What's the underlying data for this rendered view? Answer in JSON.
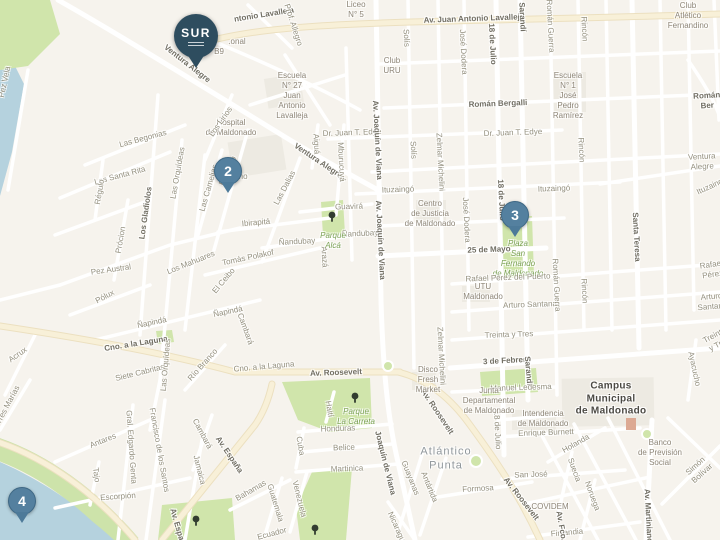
{
  "markers": [
    {
      "id": "sur",
      "label": "SUR"
    },
    {
      "id": "2",
      "label": "2"
    },
    {
      "id": "3",
      "label": "3"
    },
    {
      "id": "4",
      "label": "4"
    }
  ],
  "colors": {
    "background": "#f6f3ed",
    "water": "#b5d2de",
    "park": "#d0e5ab",
    "road_major": "#f8f0d8",
    "marker_blue": "#54809f",
    "sur_pin": "#2e4d5f"
  },
  "labels": [
    {
      "t": "ntonio Lavalleja",
      "x": 264,
      "y": 15,
      "r": -9,
      "c": "stb"
    },
    {
      "t": "Liceo\nN° 5",
      "x": 356,
      "y": 10,
      "r": 0,
      "c": "poi"
    },
    {
      "t": "Av. Juan Antonio Lavalleja",
      "x": 474,
      "y": 19,
      "r": -2,
      "c": "stb"
    },
    {
      "t": "Sarandí",
      "x": 522,
      "y": 17,
      "r": 87,
      "c": "stb"
    },
    {
      "t": "Román Guerra",
      "x": 550,
      "y": 26,
      "r": 87,
      "c": "st"
    },
    {
      "t": "Rincón",
      "x": 584,
      "y": 29,
      "r": 87,
      "c": "st"
    },
    {
      "t": "Club\nAtlético\nFernandino",
      "x": 688,
      "y": 16,
      "r": 0,
      "c": "poi"
    },
    {
      "t": "Prof. Allegro",
      "x": 293,
      "y": 25,
      "r": 72,
      "c": "st"
    },
    {
      "t": ".onal",
      "x": 237,
      "y": 42,
      "r": 0,
      "c": "poi"
    },
    {
      "t": "B9",
      "x": 219,
      "y": 52,
      "r": 0,
      "c": "poi"
    },
    {
      "t": "Ventura Alegre",
      "x": 187,
      "y": 64,
      "r": 38,
      "c": "stb"
    },
    {
      "t": "Escuela\nN° 27\nJuan\nAntonio\nLavalleja",
      "x": 292,
      "y": 96,
      "r": 0,
      "c": "poi"
    },
    {
      "t": "Club\nURU",
      "x": 392,
      "y": 66,
      "r": 0,
      "c": "poi"
    },
    {
      "t": "Solís",
      "x": 406,
      "y": 38,
      "r": 87,
      "c": "st"
    },
    {
      "t": "José Dodera",
      "x": 463,
      "y": 52,
      "r": 87,
      "c": "st"
    },
    {
      "t": "18 de Julio",
      "x": 492,
      "y": 44,
      "r": 87,
      "c": "stb"
    },
    {
      "t": "Escuela\nN° 1\nJosé\nPedro\nRamírez",
      "x": 568,
      "y": 96,
      "r": 0,
      "c": "poi"
    },
    {
      "t": "Román Bergalli",
      "x": 498,
      "y": 104,
      "r": -2,
      "c": "stb"
    },
    {
      "t": "Román Ber",
      "x": 707,
      "y": 101,
      "r": -3,
      "c": "stb"
    },
    {
      "t": "Santa Teresa",
      "x": 636,
      "y": 237,
      "r": 87,
      "c": "stb"
    },
    {
      "t": "Hospital\nde Maldonado",
      "x": 231,
      "y": 128,
      "r": 0,
      "c": "poi"
    },
    {
      "t": "Los Lirios",
      "x": 221,
      "y": 122,
      "r": -55,
      "c": "st"
    },
    {
      "t": "Dr. Juan T. Edye",
      "x": 352,
      "y": 133,
      "r": -2,
      "c": "st"
    },
    {
      "t": "Dr. Juan T. Edye",
      "x": 513,
      "y": 133,
      "r": -2,
      "c": "st"
    },
    {
      "t": "Ventura Alegre",
      "x": 318,
      "y": 161,
      "r": 34,
      "c": "stb"
    },
    {
      "t": "Ventura Alegre",
      "x": 702,
      "y": 162,
      "r": -3,
      "c": "st"
    },
    {
      "t": "Aiguá",
      "x": 316,
      "y": 144,
      "r": 87,
      "c": "st"
    },
    {
      "t": "Mburucuyá",
      "x": 341,
      "y": 162,
      "r": 87,
      "c": "st"
    },
    {
      "t": "Las Camelias",
      "x": 209,
      "y": 188,
      "r": -74,
      "c": "st"
    },
    {
      "t": "El Cedro",
      "x": 228,
      "y": 171,
      "r": -66,
      "c": "st"
    },
    {
      "t": "El Ceibo",
      "x": 224,
      "y": 281,
      "r": -50,
      "c": "st"
    },
    {
      "t": "Las Dalias",
      "x": 285,
      "y": 188,
      "r": -62,
      "c": "st"
    },
    {
      "t": "Moreno",
      "x": 234,
      "y": 177,
      "r": 0,
      "c": "st"
    },
    {
      "t": "Ibirapitá",
      "x": 256,
      "y": 223,
      "r": -5,
      "c": "st"
    },
    {
      "t": "Guavirá",
      "x": 349,
      "y": 207,
      "r": -2,
      "c": "st"
    },
    {
      "t": "Ñandubay",
      "x": 297,
      "y": 242,
      "r": -3,
      "c": "st"
    },
    {
      "t": "Ñandubay",
      "x": 360,
      "y": 234,
      "r": -3,
      "c": "st"
    },
    {
      "t": "Tomás Polakof",
      "x": 248,
      "y": 258,
      "r": -12,
      "c": "st"
    },
    {
      "t": "Arazá",
      "x": 324,
      "y": 257,
      "r": 87,
      "c": "st"
    },
    {
      "t": "Parque\nAlcá",
      "x": 333,
      "y": 241,
      "r": 0,
      "c": "park"
    },
    {
      "t": "Ituzaingó",
      "x": 398,
      "y": 190,
      "r": -2,
      "c": "st"
    },
    {
      "t": "Ituzaingó",
      "x": 554,
      "y": 189,
      "r": -2,
      "c": "st"
    },
    {
      "t": "Ituzaingó",
      "x": 712,
      "y": 186,
      "r": -25,
      "c": "st"
    },
    {
      "t": "Centro\nde Justicia\nde Maldonado",
      "x": 430,
      "y": 214,
      "r": 0,
      "c": "poi"
    },
    {
      "t": "Solís",
      "x": 413,
      "y": 150,
      "r": 87,
      "c": "st"
    },
    {
      "t": "Zelmar Michelini",
      "x": 440,
      "y": 162,
      "r": 87,
      "c": "st"
    },
    {
      "t": "Zelmar Michelini",
      "x": 441,
      "y": 356,
      "r": 87,
      "c": "st"
    },
    {
      "t": "José Dodera",
      "x": 466,
      "y": 220,
      "r": 87,
      "c": "st"
    },
    {
      "t": "18 de Julio",
      "x": 501,
      "y": 200,
      "r": 87,
      "c": "stb"
    },
    {
      "t": "18 de Julio",
      "x": 497,
      "y": 430,
      "r": 87,
      "c": "st"
    },
    {
      "t": "25 de Mayo",
      "x": 489,
      "y": 250,
      "r": -2,
      "c": "stb"
    },
    {
      "t": "Plaza\nSan\nFernando\nde Maldonado",
      "x": 518,
      "y": 259,
      "r": 0,
      "c": "park"
    },
    {
      "t": "Rafael Pérez del Puerto",
      "x": 508,
      "y": 278,
      "r": -2,
      "c": "st"
    },
    {
      "t": "Rafael Pérez",
      "x": 712,
      "y": 270,
      "r": -8,
      "c": "st"
    },
    {
      "t": "UTU\nMaldonado",
      "x": 483,
      "y": 292,
      "r": 0,
      "c": "poi"
    },
    {
      "t": "Arturo Santana",
      "x": 530,
      "y": 305,
      "r": -2,
      "c": "st"
    },
    {
      "t": "Arturo Santana",
      "x": 712,
      "y": 302,
      "r": -5,
      "c": "st"
    },
    {
      "t": "Román Guerra",
      "x": 556,
      "y": 285,
      "r": 87,
      "c": "st"
    },
    {
      "t": "Rincón",
      "x": 581,
      "y": 150,
      "r": 87,
      "c": "st"
    },
    {
      "t": "Rincón",
      "x": 584,
      "y": 291,
      "r": 87,
      "c": "st"
    },
    {
      "t": "Treinta y Tres",
      "x": 509,
      "y": 335,
      "r": -2,
      "c": "st"
    },
    {
      "t": "Treinta y Tres",
      "x": 717,
      "y": 340,
      "r": -28,
      "c": "st"
    },
    {
      "t": "3 de Febrero",
      "x": 507,
      "y": 361,
      "r": -3,
      "c": "stb"
    },
    {
      "t": "Sarandí",
      "x": 528,
      "y": 371,
      "r": 85,
      "c": "stb"
    },
    {
      "t": "Manuel Ledesma",
      "x": 521,
      "y": 388,
      "r": -2,
      "c": "st"
    },
    {
      "t": "Junta\nDepartamental\nde Maldonado",
      "x": 489,
      "y": 401,
      "r": 0,
      "c": "poi"
    },
    {
      "t": "Intendencia\nde Maldonado",
      "x": 543,
      "y": 419,
      "r": 0,
      "c": "poi"
    },
    {
      "t": "Enrique Burnett",
      "x": 546,
      "y": 433,
      "r": -2,
      "c": "st"
    },
    {
      "t": "Campus\nMunicipal\nde Maldonado",
      "x": 611,
      "y": 399,
      "r": 0,
      "c": "campus"
    },
    {
      "t": "Holanda",
      "x": 576,
      "y": 444,
      "r": -30,
      "c": "st"
    },
    {
      "t": "Banco\nde Previsión\nSocial",
      "x": 660,
      "y": 453,
      "r": 0,
      "c": "poi"
    },
    {
      "t": "Ayacucho",
      "x": 694,
      "y": 369,
      "r": 78,
      "c": "st"
    },
    {
      "t": "San José",
      "x": 531,
      "y": 475,
      "r": -2,
      "c": "st"
    },
    {
      "t": "COVIDEM",
      "x": 550,
      "y": 507,
      "r": 0,
      "c": "poi"
    },
    {
      "t": "Formosa",
      "x": 478,
      "y": 489,
      "r": -3,
      "c": "st"
    },
    {
      "t": "Suecia",
      "x": 574,
      "y": 470,
      "r": 70,
      "c": "st"
    },
    {
      "t": "Noruega",
      "x": 592,
      "y": 496,
      "r": 70,
      "c": "st"
    },
    {
      "t": "Finlandia",
      "x": 567,
      "y": 533,
      "r": -5,
      "c": "st"
    },
    {
      "t": "Av. Martiniano",
      "x": 648,
      "y": 516,
      "r": 87,
      "c": "stb"
    },
    {
      "t": "Simón Bolívar",
      "x": 699,
      "y": 470,
      "r": -42,
      "c": "st"
    },
    {
      "t": "Av. Fco.",
      "x": 561,
      "y": 526,
      "r": 80,
      "c": "stb"
    },
    {
      "t": "Av. Roosevelt",
      "x": 336,
      "y": 373,
      "r": -2,
      "c": "stb"
    },
    {
      "t": "Av. Roosevelt",
      "x": 437,
      "y": 412,
      "r": 56,
      "c": "stb"
    },
    {
      "t": "Av. Roosevelt",
      "x": 521,
      "y": 499,
      "r": 52,
      "c": "stb"
    },
    {
      "t": "Disco\nFresh\nMarket",
      "x": 428,
      "y": 380,
      "r": 0,
      "c": "poi"
    },
    {
      "t": "Atlántico\nPunta",
      "x": 446,
      "y": 459,
      "r": 0,
      "c": "area"
    },
    {
      "t": "Guayanas",
      "x": 410,
      "y": 478,
      "r": 68,
      "c": "st"
    },
    {
      "t": "Antártida",
      "x": 429,
      "y": 487,
      "r": 68,
      "c": "st"
    },
    {
      "t": "Joaquín de Viana",
      "x": 385,
      "y": 463,
      "r": 76,
      "c": "stb"
    },
    {
      "t": "Av. Joaquín de Viana",
      "x": 377,
      "y": 140,
      "r": 87,
      "c": "stb"
    },
    {
      "t": "Av. Joaquín de Viana",
      "x": 380,
      "y": 240,
      "r": 87,
      "c": "stb"
    },
    {
      "t": "Honduras",
      "x": 338,
      "y": 429,
      "r": -2,
      "c": "st"
    },
    {
      "t": "Belice",
      "x": 344,
      "y": 448,
      "r": -2,
      "c": "st"
    },
    {
      "t": "Martinica",
      "x": 347,
      "y": 469,
      "r": -2,
      "c": "st"
    },
    {
      "t": "Haití",
      "x": 329,
      "y": 409,
      "r": 80,
      "c": "st"
    },
    {
      "t": "Cuba",
      "x": 300,
      "y": 446,
      "r": 80,
      "c": "st"
    },
    {
      "t": "Venezuela",
      "x": 299,
      "y": 499,
      "r": 76,
      "c": "st"
    },
    {
      "t": "Guatemala",
      "x": 275,
      "y": 503,
      "r": 73,
      "c": "st"
    },
    {
      "t": "Bahamas",
      "x": 251,
      "y": 491,
      "r": -30,
      "c": "st"
    },
    {
      "t": "Jamaica",
      "x": 199,
      "y": 470,
      "r": 76,
      "c": "st"
    },
    {
      "t": "Cambará",
      "x": 202,
      "y": 434,
      "r": 62,
      "c": "st"
    },
    {
      "t": "Cambará",
      "x": 245,
      "y": 329,
      "r": 70,
      "c": "st"
    },
    {
      "t": "Francisco de los Santos",
      "x": 159,
      "y": 450,
      "r": 80,
      "c": "st"
    },
    {
      "t": "Gral. Edgardo Genta",
      "x": 131,
      "y": 447,
      "r": 86,
      "c": "st"
    },
    {
      "t": "Antares",
      "x": 103,
      "y": 441,
      "r": -22,
      "c": "st"
    },
    {
      "t": "Tajo",
      "x": 96,
      "y": 475,
      "r": 82,
      "c": "st"
    },
    {
      "t": "Escorpión",
      "x": 118,
      "y": 497,
      "r": -4,
      "c": "st"
    },
    {
      "t": "Av. España",
      "x": 229,
      "y": 455,
      "r": 56,
      "c": "stb"
    },
    {
      "t": "Av. España",
      "x": 178,
      "y": 529,
      "r": 74,
      "c": "stb"
    },
    {
      "t": "Parque\nLa Carreta",
      "x": 356,
      "y": 417,
      "r": 0,
      "c": "park"
    },
    {
      "t": "Cno. a la Laguna",
      "x": 136,
      "y": 344,
      "r": -9,
      "c": "stb"
    },
    {
      "t": "Cno. a la Laguna",
      "x": 264,
      "y": 367,
      "r": -5,
      "c": "st"
    },
    {
      "t": "Siete Cabritas",
      "x": 140,
      "y": 373,
      "r": -14,
      "c": "st"
    },
    {
      "t": "Las Orquídeas",
      "x": 178,
      "y": 173,
      "r": -80,
      "c": "st"
    },
    {
      "t": "Las Orquídeas",
      "x": 166,
      "y": 365,
      "r": -85,
      "c": "st"
    },
    {
      "t": "Los Gladiolos",
      "x": 146,
      "y": 213,
      "r": -82,
      "c": "stb"
    },
    {
      "t": "Las Begonias",
      "x": 143,
      "y": 139,
      "r": -15,
      "c": "st"
    },
    {
      "t": "Las Santa Rita",
      "x": 120,
      "y": 176,
      "r": -15,
      "c": "st"
    },
    {
      "t": "Régulo",
      "x": 100,
      "y": 192,
      "r": -80,
      "c": "st"
    },
    {
      "t": "Prócion",
      "x": 121,
      "y": 240,
      "r": -80,
      "c": "st"
    },
    {
      "t": "Pez Austral",
      "x": 111,
      "y": 270,
      "r": -8,
      "c": "st"
    },
    {
      "t": "Pólux",
      "x": 105,
      "y": 297,
      "r": -28,
      "c": "st"
    },
    {
      "t": "Los Mahuares",
      "x": 191,
      "y": 263,
      "r": -22,
      "c": "st"
    },
    {
      "t": "Ñapindá",
      "x": 152,
      "y": 323,
      "r": -12,
      "c": "st"
    },
    {
      "t": "Ñapindá",
      "x": 228,
      "y": 312,
      "r": -12,
      "c": "st"
    },
    {
      "t": "Río Branco",
      "x": 203,
      "y": 365,
      "r": -48,
      "c": "st"
    },
    {
      "t": "Acrux",
      "x": 18,
      "y": 355,
      "r": -35,
      "c": "st"
    },
    {
      "t": "Tres Marías",
      "x": 8,
      "y": 405,
      "r": -62,
      "c": "st"
    },
    {
      "t": "Pez Vela",
      "x": 5,
      "y": 82,
      "r": -78,
      "c": "st"
    },
    {
      "t": "Nicaragua",
      "x": 397,
      "y": 529,
      "r": 66,
      "c": "st"
    },
    {
      "t": "Ecuador",
      "x": 272,
      "y": 534,
      "r": -15,
      "c": "st"
    }
  ]
}
